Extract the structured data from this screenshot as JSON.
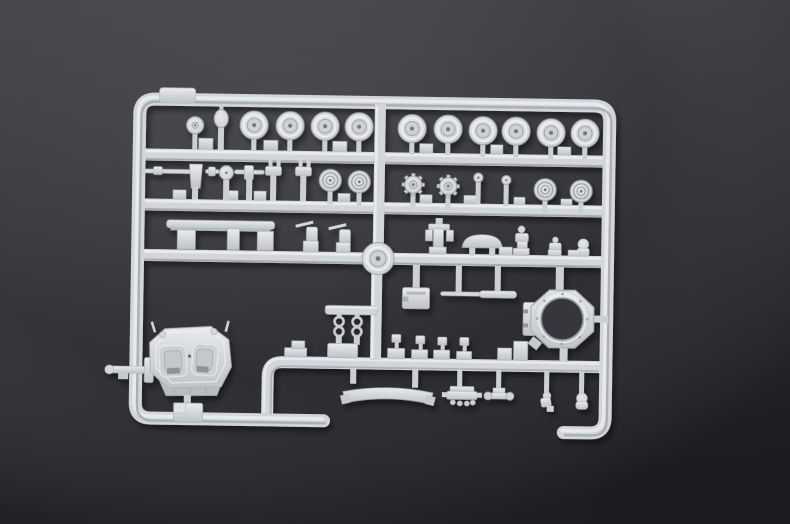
{
  "scene": {
    "type": "photograph",
    "subject": "Unassembled light-grey styrene model kit sprue with tank parts on a dark matte backdrop",
    "colors": {
      "background_top": "#48474d",
      "background_middle": "#3a393f",
      "background_bottom": "#26252a",
      "plastic_base": "#d3d6d9",
      "plastic_highlight": "#ebedef",
      "plastic_shadow": "#a7adb3",
      "plastic_deep_shadow": "#8f969c",
      "ring_hole": "#37363c"
    },
    "labels": {
      "photo": "Product photo of a light grey injection-moulded model sprue",
      "frame": "Sprue runner frame",
      "road_wheels": "Road wheel parts",
      "idler_wheels": "Ribbed idler wheel parts",
      "sprockets": "Toothed drive sprocket parts",
      "barrels": "Gun barrel assemblies",
      "rail": "Long rail part",
      "machine_guns": "Machine gun parts",
      "hub_disc": "Hub disc at runner junction",
      "dome_hatch": "Domed hatch part",
      "figures": "Small detail and figure parts",
      "ammo_box": "Box part",
      "thin_barrel": "Thin barrel rod part",
      "track_chains": "Track link chain parts",
      "turret": "Tank turret shell part",
      "stowage_box": "Stowage box part",
      "clamp": "Clamp part on left runner",
      "turret_ring": "Turret ring part",
      "fender": "Curved fender strip part",
      "engine": "Engine block part",
      "axle": "Axle bracket part"
    },
    "part_inventory": {
      "large_road_wheels": 10,
      "small_road_wheel": 1,
      "domed_knob": 1,
      "ribbed_idler_wheels": 4,
      "toothed_sprockets": 2,
      "small_pins": 2,
      "barrel_assemblies": 3,
      "vision_blocks": 2,
      "long_rail": 1,
      "machine_guns": 2,
      "hub_disc": 1,
      "bracket": 1,
      "dome_hatch": 1,
      "figure_parts": 3,
      "box_parts": 2,
      "thin_barrel_rod": 1,
      "track_chains": 2,
      "turret_shell": 1,
      "turret_ring": 1,
      "curved_fender": 1,
      "engine_block": 1,
      "axle_bracket": 1,
      "misc_small_parts": 2
    }
  }
}
